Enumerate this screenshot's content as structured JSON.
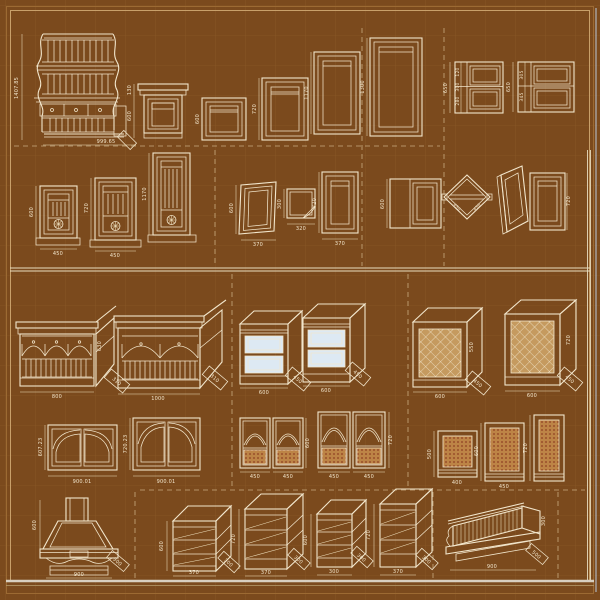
{
  "palette": {
    "background": "#7b4a1d",
    "grid_line": "#8a5826",
    "drawing_line": "#f2e6cc",
    "dashed_separator": "#d9c49a",
    "divider_line": "#e9ddbf",
    "drawer_fill": "#dde9f3",
    "lattice_fill": "#c59a5f",
    "mesh_fill": "#bd8446",
    "mesh_dot": "#8f3f22",
    "edge_highlight": "#b9c6d6"
  },
  "row1": {
    "corner_cabinet": {
      "h": "1407.85",
      "w": "999.65"
    },
    "small_cabinet": {
      "d1": "130",
      "d2": "600"
    },
    "door_a": {
      "h": "600"
    },
    "door_b": {
      "h": "720"
    },
    "tall_door_a": {
      "h": "1170"
    },
    "tall_door_b": {
      "h": "1300"
    },
    "stack_a": {
      "h": "650",
      "s1": "120",
      "s2": "300",
      "s3": "280"
    },
    "stack_b": {
      "h": "650",
      "s1": "305",
      "s2": "345"
    }
  },
  "row2": {
    "rosette_a": {
      "h": "600",
      "w": "450"
    },
    "rosette_b": {
      "h": "720",
      "w": "450"
    },
    "rosette_c": {
      "h": "1170"
    },
    "skew_door": {
      "h": "600",
      "w": "370"
    },
    "folded_panel": {
      "h": "300",
      "w": "320"
    },
    "door_720": {
      "h": "720",
      "w": "370"
    },
    "plain_door": {
      "h": "600"
    },
    "diamond": {
      "d1": "450",
      "d2": "450"
    },
    "door_right": {
      "h": "720"
    }
  },
  "row3": {
    "plate_rack_a": {
      "w": "800",
      "h": "630",
      "d": "310"
    },
    "plate_rack_b": {
      "w": "1000",
      "d": "310"
    },
    "drawer_a": {
      "w": "600",
      "d": "450"
    },
    "drawer_b": {
      "w": "600",
      "d": "450"
    },
    "lattice_a": {
      "w": "600",
      "h": "550",
      "d": "450"
    },
    "lattice_b": {
      "w": "600",
      "h": "720",
      "d": "450"
    }
  },
  "row4": {
    "arch_a": {
      "h": "607.23",
      "w": "900.01"
    },
    "arch_b": {
      "h": "720.23",
      "w": "900.01"
    },
    "pair_a": {
      "h": "600",
      "w1": "450",
      "w2": "450"
    },
    "pair_b": {
      "h": "720",
      "w1": "450",
      "w2": "450"
    },
    "mesh_a": {
      "h": "500",
      "w": "400"
    },
    "mesh_b": {
      "h": "600",
      "w": "450"
    },
    "mesh_c": {
      "h": "720"
    }
  },
  "row5": {
    "hood": {
      "h": "600",
      "w": "900",
      "d": "300"
    },
    "shelf_a": {
      "h": "600",
      "w": "370",
      "d": "300"
    },
    "shelf_b": {
      "h": "720",
      "w": "370",
      "d": "300"
    },
    "shelf_c": {
      "h": "600",
      "w": "300",
      "d": "300"
    },
    "shelf_d": {
      "h": "720",
      "w": "370",
      "d": "300"
    },
    "wide_hood": {
      "w": "900",
      "h": "300",
      "d": "500"
    }
  }
}
